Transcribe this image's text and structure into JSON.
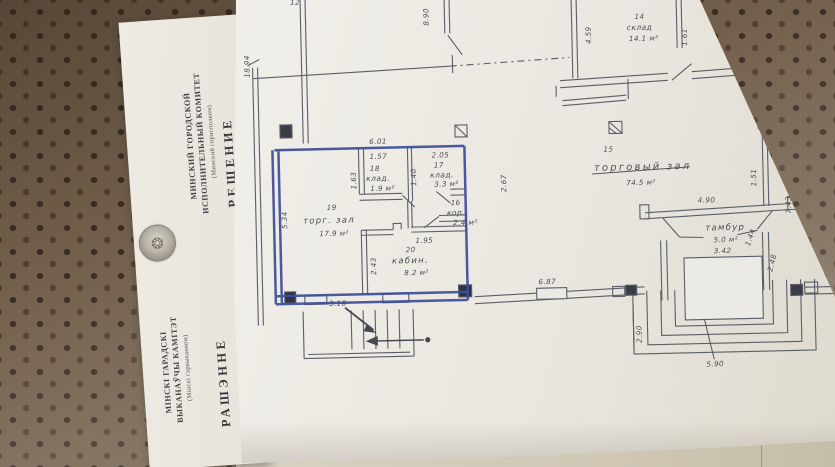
{
  "letterhead": {
    "be": {
      "line1": "МІНСКІ ГАРАДСКІ",
      "line2": "ВЫКАНАЎЧЫ КАМІТЭТ",
      "line3": "(Мінскі гарвыканком)",
      "title": "РАШЭННЕ"
    },
    "ru": {
      "line1": "МИНСКИЙ ГОРОДСКОЙ",
      "line2": "ИСПОЛНИТЕЛЬНЫЙ КОМИТЕТ",
      "line3": "(Минский горисполком)",
      "title": "РЕШЕНИЕ"
    },
    "emblem_icon": "coat-of-arms"
  },
  "plan": {
    "rooms": {
      "r14": {
        "num": "14",
        "label": "склад",
        "area": "14.1 м²"
      },
      "r13": {
        "num": "13",
        "label": "склад",
        "area": "14.8 м²"
      },
      "r15": {
        "num": "15",
        "label": "торговый зал",
        "area": "74.5 м²"
      },
      "r18": {
        "num": "18",
        "label": "клад.",
        "area": "1.9 м²"
      },
      "r17": {
        "num": "17",
        "label": "клад.",
        "area": "3.3 м²"
      },
      "r19": {
        "num": "19",
        "label": "торг. зал",
        "area": "17.9 м²"
      },
      "r16": {
        "num": "16",
        "label": "кор.",
        "area": "2.4 м²"
      },
      "r20": {
        "num": "20",
        "label": "кабин.",
        "area": "8.2 м²"
      },
      "tambour": {
        "num": "",
        "label": "тамбур",
        "area": "5.0 м²"
      }
    },
    "dims": {
      "d1894": "18.94",
      "d12": "12",
      "d890": "8.90",
      "d373": "3.73",
      "d383": "3.83",
      "d459": "4.59",
      "d161": "1.61",
      "d16": "1.6",
      "d151": "1.51",
      "d743": "7.43",
      "d490": "4.90",
      "d342": "3.42",
      "d144": "1.44",
      "d248": "2.48",
      "d290": "2.90",
      "d590": "5.90",
      "d687": "6.87",
      "d601": "6.01",
      "d157": "1.57",
      "d205": "2.05",
      "d163": "1.63",
      "d140": "1.40",
      "d267": "2.67",
      "d534": "5.34",
      "d195": "1.95",
      "d243": "2.43",
      "d318": "3.18"
    }
  },
  "colors": {
    "pegboard": "#72604c",
    "pegboard_dot": "#3a2d22",
    "plan_paper": "#ece9e2",
    "letter_paper": "#ebe8e1",
    "pencil": "#5b5e68",
    "blue_pen": "#3c4c99",
    "under_paper": "#d2cab8"
  }
}
